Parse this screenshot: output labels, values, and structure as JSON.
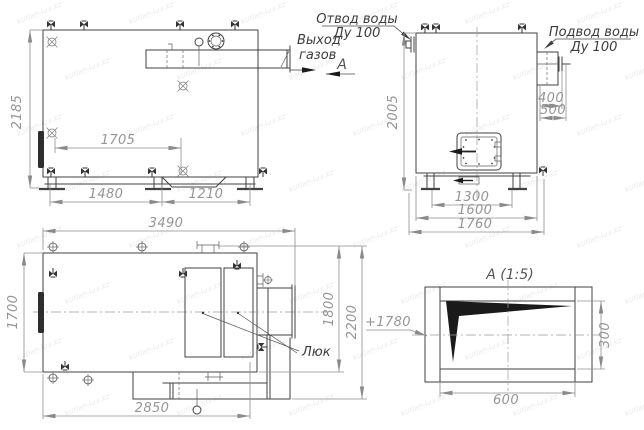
{
  "watermark": {
    "text": "kotlan-lux.kz"
  },
  "labels": {
    "gas_outlet_1": "Выход",
    "gas_outlet_2": "газов",
    "section_letter": "А",
    "water_outlet_1": "Отвод воды",
    "water_outlet_2": "Ду 100",
    "water_inlet_1": "Подвод воды",
    "water_inlet_2": "Ду 100",
    "hatch_label": "Люк",
    "detail_title": "А (1:5)",
    "elevation_mark": "+1780"
  },
  "dims": {
    "d2185": "2185",
    "d1705": "1705",
    "d1480": "1480",
    "d1210": "1210",
    "d2005": "2005",
    "d400": "400",
    "d500": "500",
    "d1300": "1300",
    "d1600": "1600",
    "d1760": "1760",
    "d3490": "3490",
    "d1700": "1700",
    "d2850": "2850",
    "d1800": "1800",
    "d2200": "2200",
    "d600": "600",
    "d300": "300"
  }
}
